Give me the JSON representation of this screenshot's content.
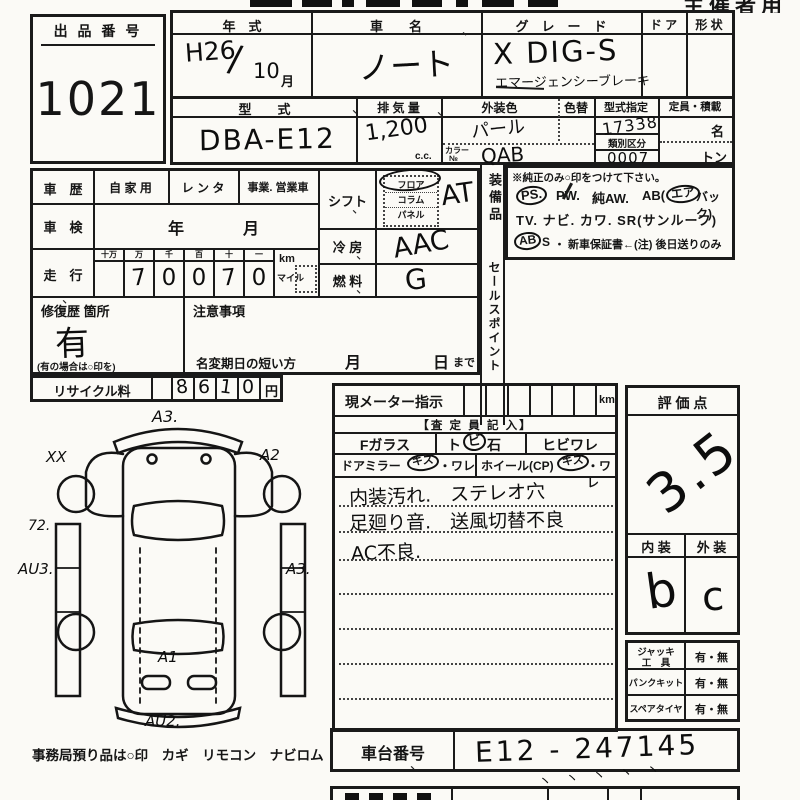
{
  "misc": {
    "tick": "、",
    "tick_marks": "ヽ ヽ ヽ ヽ ヽ"
  },
  "header": {
    "right_title": "主催者用"
  },
  "lot": {
    "label": "出 品 番 号",
    "number": "1021"
  },
  "spec": {
    "year_label": "年　式",
    "year_value": "H26",
    "year_slash": "/",
    "year_month": "10",
    "month_suffix": "月",
    "name_label": "車　　名",
    "name_value": "ノート",
    "grade_label": "グ　レ　ー　ド",
    "grade_value": "X DIG-S",
    "grade_note": "エマージェンシーブレーキ",
    "door_label": "ド ア",
    "shape_label": "形 状",
    "model_label": "型　　式",
    "model_value": "DBA-E12",
    "disp_label": "排 気 量",
    "disp_value": "1,200",
    "disp_unit": "c.c.",
    "color_label": "外装色",
    "color_value": "パール",
    "color_change_label": "色替",
    "color_no_label": "カラー",
    "color_no_label2": "№",
    "color_no_value": "QAB",
    "type_desig_label": "型式指定",
    "type_desig_value": "17338",
    "class_label": "類別区分",
    "class_value": "0007",
    "capacity_label": "定員・積載",
    "capacity_persons": "名",
    "capacity_load": "トン"
  },
  "history": {
    "label": "車　歴",
    "options": [
      "自 家 用",
      "レ ン タ",
      "事業. 営業車"
    ],
    "shaken_label": "車　検",
    "shaken_year": "年",
    "shaken_month": "月",
    "mileage_label": "走　行",
    "mileage_columns": [
      "十万",
      "万",
      "千",
      "百",
      "十",
      "一"
    ],
    "mileage_digits": [
      "",
      "7",
      "0",
      "0",
      "7",
      "0"
    ],
    "unit_km": "km",
    "unit_mile": "マイル"
  },
  "controls": {
    "shift_label": "シフト",
    "shift_options": [
      "フロア",
      "コラム",
      "パネル"
    ],
    "shift_value": "AT",
    "cooling_label": "冷 房",
    "cooling_value": "AAC",
    "fuel_label": "燃 料",
    "fuel_value": "G"
  },
  "repair": {
    "label": "修復歴 箇所",
    "value": "有",
    "note": "(有の場合は○印を)"
  },
  "caution": {
    "label": "注意事項",
    "name_change_label": "名変期日の短い方",
    "month": "月",
    "day": "日",
    "until": "まで"
  },
  "recycle": {
    "label": "リサイクル料",
    "digits": [
      "8",
      "6",
      "1",
      "0"
    ],
    "unit": "円"
  },
  "equipment": {
    "vertical_label": "装備品",
    "note": "※純正のみ○印をつけて下さい。",
    "ps": "PS.",
    "pw": "PW.",
    "aw": "純AW.",
    "ab_prefix": "AB(",
    "ab_circled": "エア",
    "ab_suffix": "バック)",
    "row2": "TV. ナビ. カワ. SR(サンルーフ)",
    "abs_circled": "AB",
    "abs_rest": "S",
    "warranty": "・ 新車保証書←(注) 後日送りのみ"
  },
  "sales_point": {
    "vertical_label": "セールスポイント"
  },
  "meter": {
    "label": "現メーター指示",
    "unit": "km"
  },
  "assessor": {
    "header": "【査 定 員 記 入】",
    "fglass_label": "Fガラス",
    "fglass_opt1_pre": "ト",
    "fglass_opt1_circled": "ビ",
    "fglass_opt1_post": "石",
    "fglass_opt2": "ヒビワレ",
    "mirror_label": "ドアミラー",
    "mirror_circled": "キズ",
    "mirror_rest": "・ワレ",
    "wheel_label": "ホイール(CP)",
    "wheel_circled": "キズ",
    "wheel_rest": "・ワレ",
    "notes": [
      "内装汚れ.　ステレオ穴",
      "足廻り音.　送風切替不良",
      "AC不良."
    ]
  },
  "score": {
    "label": "評 価 点",
    "value": "3.5",
    "interior_label": "内 装",
    "exterior_label": "外 装",
    "interior_value": "b",
    "exterior_value": "c"
  },
  "tools": {
    "rows": [
      {
        "label": "ジャッキ",
        "label2": "工　具",
        "value": "有・無"
      },
      {
        "label": "パンクキット",
        "label2": "",
        "value": "有・無"
      },
      {
        "label": "スペアタイヤ",
        "label2": "",
        "value": "有・無"
      }
    ]
  },
  "chassis": {
    "label": "車台番号",
    "value": "E12 - 247145"
  },
  "diagram": {
    "annotations": [
      "A3.",
      "XX",
      "A2",
      "72.",
      "AU3.",
      "A3.",
      "A1",
      "AU2."
    ],
    "footer": "事務局預り品は○印　カギ　リモコン　ナビロム"
  }
}
